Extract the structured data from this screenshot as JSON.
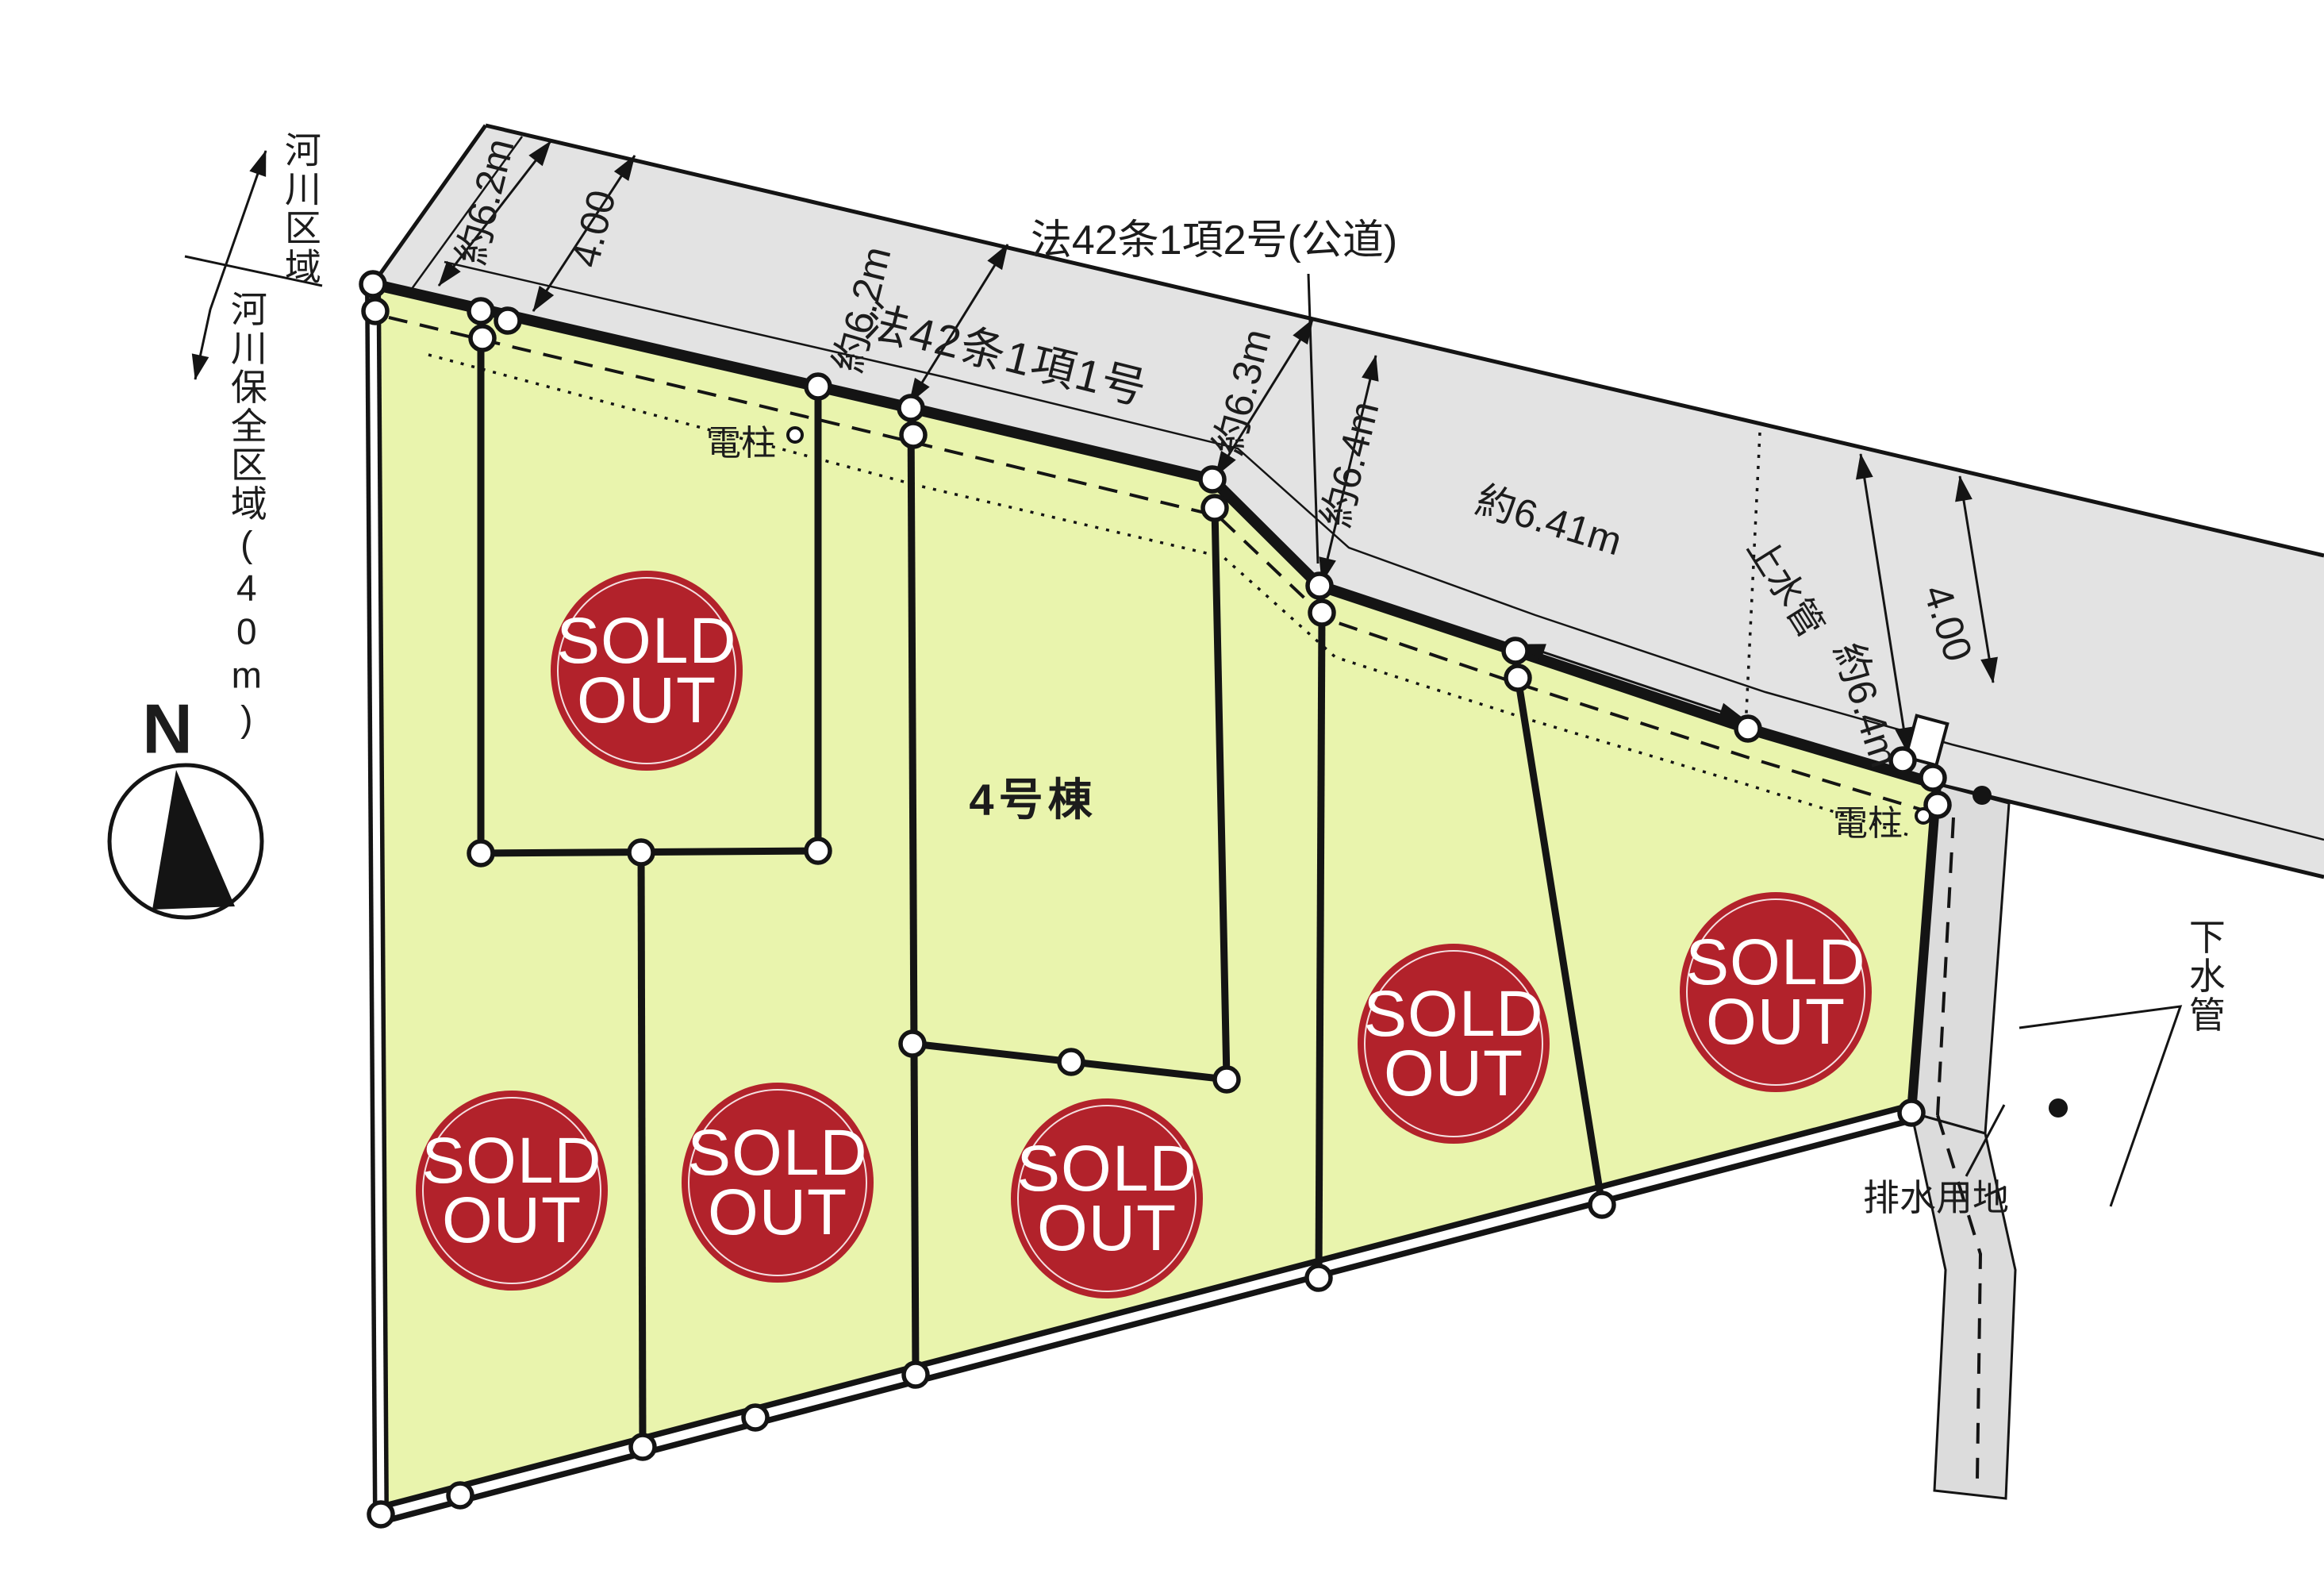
{
  "compass": {
    "north": "N"
  },
  "zones": {
    "river_area": "河川区域",
    "river_preservation": "河川保全区域(40m)"
  },
  "roads": {
    "article42_1_1": "法42条1項1号",
    "article42_1_2": "法42条1項2号(公道)"
  },
  "dimensions": {
    "w62_left": "約6.2m",
    "w400_left": "4.00",
    "w62_mid": "約6.2m",
    "w63": "約6.3m",
    "w64_mid": "約6.4m",
    "w641": "約6.41m",
    "w64_right": "約6.4m",
    "w400_right": "4.00"
  },
  "utilities": {
    "pole_left": "電柱",
    "pole_right": "電柱",
    "water_main": "上水管",
    "sewer_pipe": "下水管",
    "drainage_land": "排水用地"
  },
  "badge": {
    "line1": "SOLD",
    "line2": "OUT"
  },
  "lots": {
    "available_label": "4号棟",
    "sold_out_count": 6
  },
  "colors": {
    "parcel_green": "#e9f4ad",
    "road_gray": "#e3e3e3",
    "strip_gray": "#dcdcdc",
    "badge_red": "#b2222b",
    "line_black": "#141414"
  }
}
